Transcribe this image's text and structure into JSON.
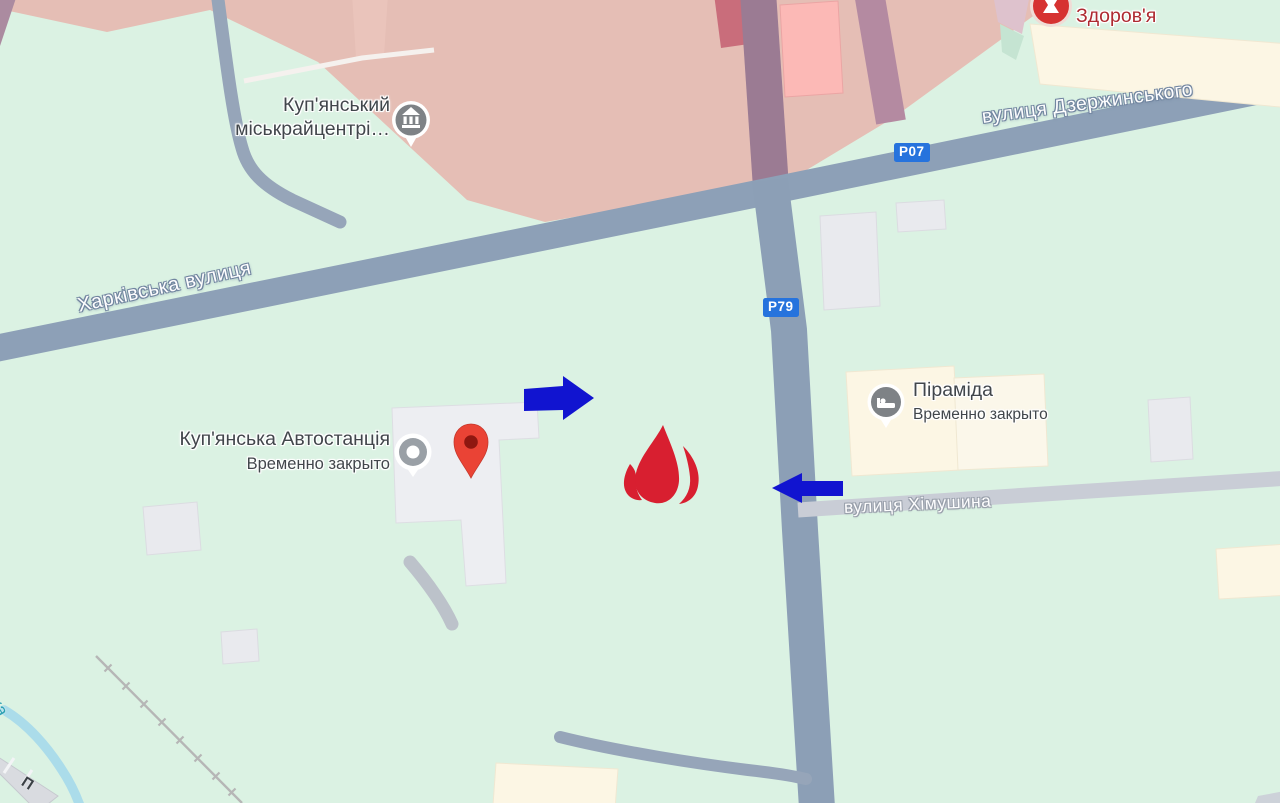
{
  "streets": {
    "kharkivska": "Харківська вулиця",
    "dzerzhynskoho": "вулиця Дзержинського",
    "khimushyna": "вулиця Хімушина"
  },
  "badges": {
    "p07": "P07",
    "p79": "P79"
  },
  "pois": {
    "kupianskyi": {
      "line1": "Куп'янський",
      "line2": "міськрайцентрі…"
    },
    "zdorovia": {
      "name": "Здоров'я"
    },
    "avtostantsiia": {
      "name": "Куп'янська Автостанція",
      "status": "Временно закрыто"
    },
    "piramida": {
      "name": "Піраміда",
      "status": "Временно закрыто"
    }
  },
  "partials": {
    "river": "ка",
    "road": "П"
  },
  "colors": {
    "land": "#dbf2e3",
    "road_major": "#8da0b7",
    "road_minor": "#c9cdd6",
    "area_commercial": "#e5beb5",
    "building_gray": "#e9eaee",
    "building_cream": "#fcf6e4",
    "building_pink": "#fcb9b6",
    "water": "#abdcea",
    "railway": "#b6b6b6",
    "arrow_blue": "#1114d0",
    "flame_red": "#d81f30",
    "pin_red": "#ea4335",
    "pin_red_dark": "#8f1710",
    "badge_blue": "#2673dd",
    "label_dark": "#41464b",
    "label_red": "#ae2a31",
    "water_label": "#2a9fb3"
  }
}
